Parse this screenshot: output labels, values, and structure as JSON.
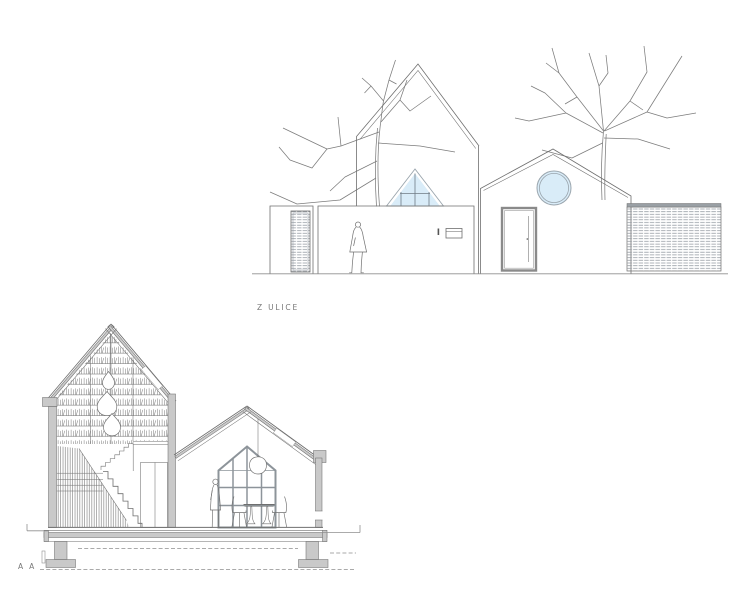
{
  "labels": {
    "elevation_caption": "Z ULICE",
    "section_caption": "A A"
  },
  "colors": {
    "background": "#ffffff",
    "line": "#6f6f6f",
    "light_line": "#8f8f8f",
    "poche_gray": "#c9c9c9",
    "glazing_blue": "#d9ecf8",
    "frame_gray": "#9aa5ad",
    "label_text": "#787878"
  },
  "icons": {
    "drawing_type_top": "street-elevation-drawing",
    "drawing_type_bottom": "cross-section-drawing"
  }
}
